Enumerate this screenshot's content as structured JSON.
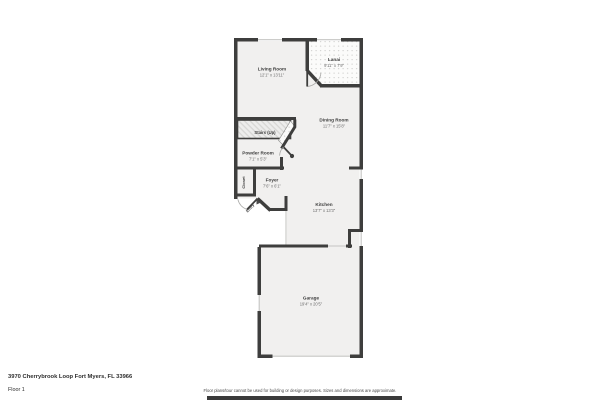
{
  "page": {
    "address": "3970 Cherrybrook Loop Fort Myers, FL 33966",
    "floor_label": "Floor 1",
    "disclaimer": "Floor plans/tour cannot be used for building or design purposes. Sizes and dimensions are approximate."
  },
  "colors": {
    "wall": "#3e3e3d",
    "floor_fill": "#f1f0ef",
    "page_background": "#ffffff",
    "room_label": "#3c3c3c",
    "dimension_label": "#6e6e6e",
    "footer_bar": "#3a3a3a"
  },
  "rooms": {
    "living_room": {
      "name": "Living Room",
      "dims": "12'1\" x 13'11\""
    },
    "lanai": {
      "name": "Lanai",
      "dims": "9'11\" x 7'9\""
    },
    "dining_room": {
      "name": "Dining Room",
      "dims": "11'7\" x 15'8\""
    },
    "stairs": {
      "name": "Stairs (Up)"
    },
    "powder_room": {
      "name": "Powder Room",
      "dims": "7'1\" x 5'3\""
    },
    "closet": {
      "name": "Closet"
    },
    "foyer": {
      "name": "Foyer",
      "dims": "7'6\" x 6'1\""
    },
    "entry": {
      "name": "Entry"
    },
    "kitchen": {
      "name": "Kitchen",
      "dims": "13'7\" x 13'3\""
    },
    "garage": {
      "name": "Garage",
      "dims": "19'4\" x 20'5\""
    }
  }
}
